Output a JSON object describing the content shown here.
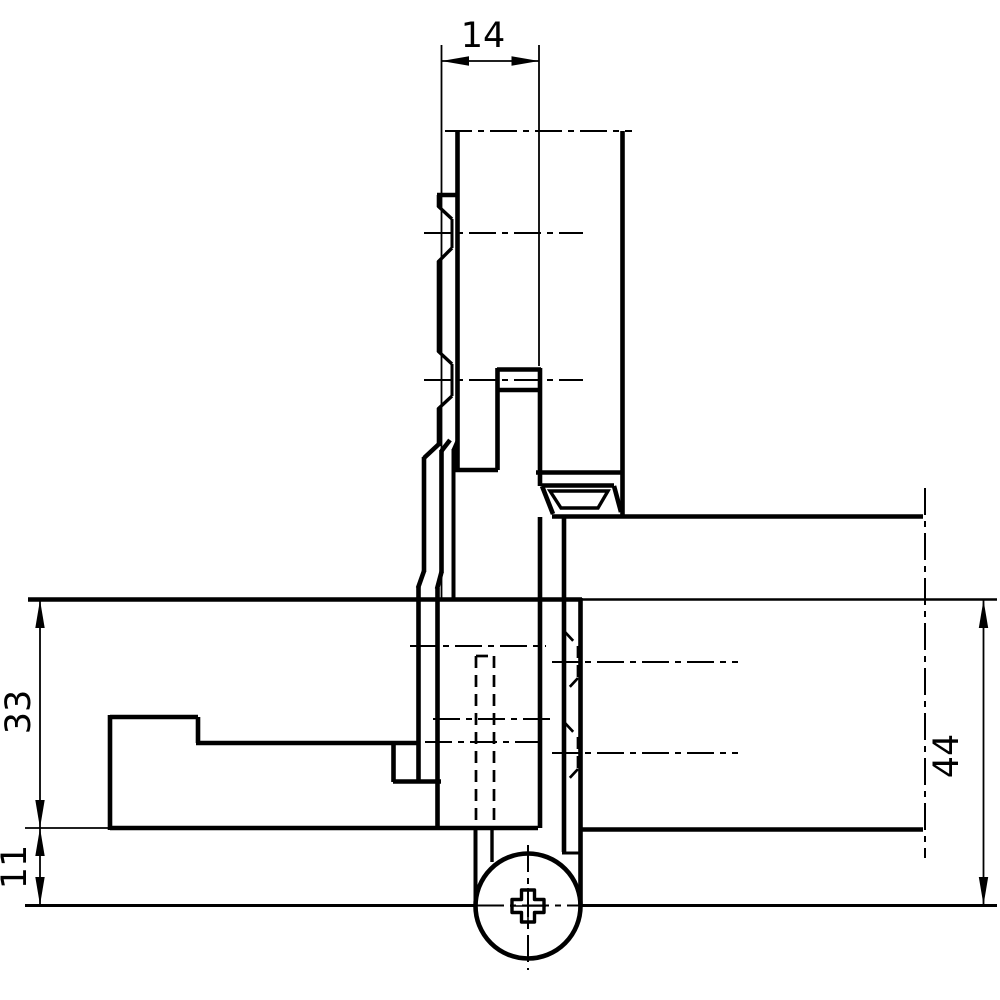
{
  "drawing": {
    "type": "technical cross-section drawing",
    "subject": "door hinge installation section with frame and fixing screw",
    "background_color": "#ffffff",
    "line_color": "#000000",
    "dimensions": {
      "flange_to_pin_width": "14",
      "frame_overlap_height": "33",
      "frame_lower_height": "11",
      "frame_total_height": "44"
    }
  }
}
